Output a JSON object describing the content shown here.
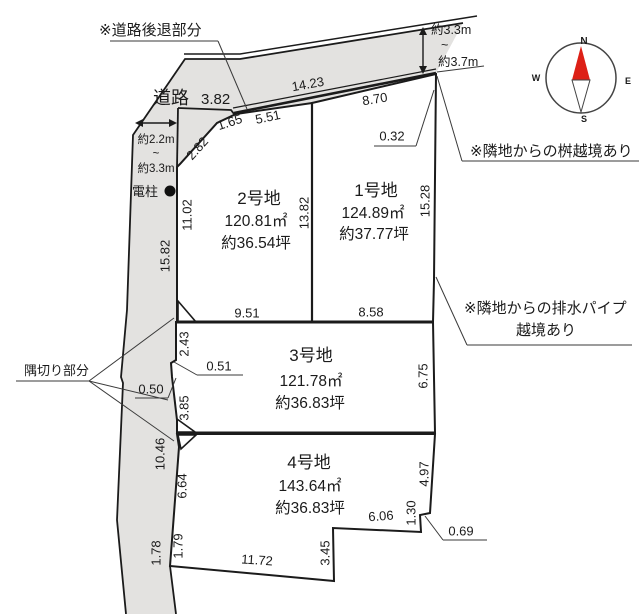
{
  "colors": {
    "road": "#e3e2e0",
    "plot": "#dcebd3",
    "cut": "#ffffff",
    "needle": "#dd2016",
    "needle_tail": "#ffffff",
    "north_label": "#b3282d"
  },
  "compass": {
    "n": "N",
    "e": "E",
    "s": "S",
    "w": "W"
  },
  "road": {
    "label": "道路",
    "front_width": "3.82",
    "top_length": "14.23",
    "edge_upper": "15.82",
    "edge_lower": "10.46",
    "edge_bottom": "1.78",
    "edge_jog": "0.50",
    "width_top": {
      "min": "約3.3m",
      "tilde": "~",
      "max": "約3.7m"
    },
    "width_left": {
      "min": "約2.2m",
      "tilde": "~",
      "max": "約3.3m"
    }
  },
  "annotations": {
    "setback": "※道路後退部分",
    "pole": "電柱",
    "corner_cut": "隅切り部分",
    "masu": "※隣地からの桝越境あり",
    "drain_line1": "※隣地からの排水パイプ",
    "drain_line2": "越境あり"
  },
  "plots": [
    {
      "name": "1号地",
      "area": "124.89㎡",
      "tsubo": "約37.77坪",
      "dims": {
        "top": "8.70",
        "notch": "0.32",
        "right": "15.28",
        "left": "13.82",
        "bottom": "8.58"
      }
    },
    {
      "name": "2号地",
      "area": "120.81㎡",
      "tsubo": "約36.54坪",
      "dims": {
        "chamfer": "2.82",
        "chamfer2": "1.65",
        "top": "5.51",
        "left": "11.02",
        "bottom": "9.51"
      }
    },
    {
      "name": "3号地",
      "area": "121.78㎡",
      "tsubo": "約36.83坪",
      "dims": {
        "left_upper": "2.43",
        "jog": "0.51",
        "left_lower": "3.85",
        "right": "6.75"
      }
    },
    {
      "name": "4号地",
      "area": "143.64㎡",
      "tsubo": "約36.83坪",
      "dims": {
        "left_upper": "6.64",
        "left_lower": "1.79",
        "bottom": "11.72",
        "step_v": "3.45",
        "step_h": "6.06",
        "notch_v": "1.30",
        "notch": "0.69",
        "right": "4.97"
      }
    }
  ]
}
